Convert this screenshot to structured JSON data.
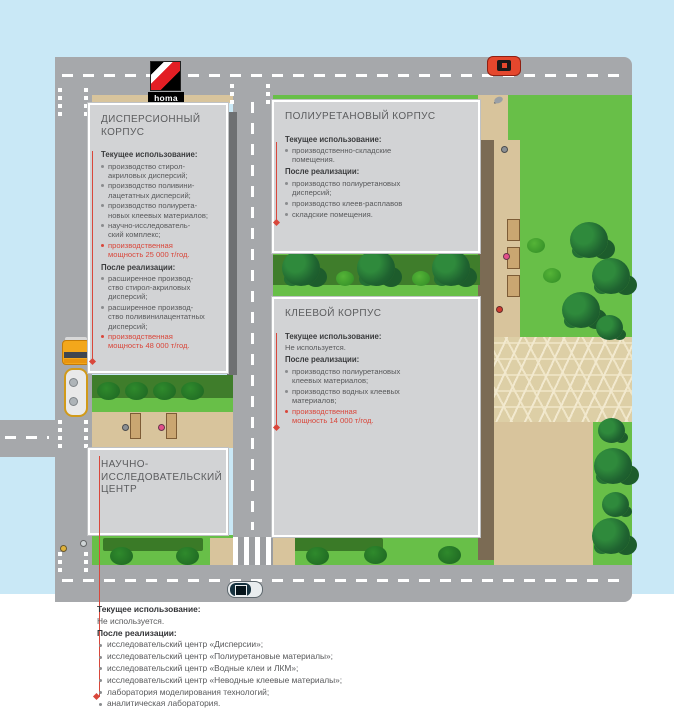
{
  "palette": {
    "accent_red": "#d9473b",
    "grass_green": "#68bf48",
    "road_gray": "#a6a8ab",
    "water_blue": "#c9e8f6",
    "box_gray": "#d2d3d5",
    "path_tan": "#d8c49c",
    "logo_red": "#e31e24"
  },
  "logo": {
    "text": "homa"
  },
  "icons": {
    "red-car": "css-shape",
    "sedan-car": "css-shape",
    "tanker-truck": "css-shape",
    "bench": "css-shape",
    "tree": "css-circle-cluster",
    "bush": "css-circle",
    "pedestrian": "css-dot",
    "bird": "css-oval"
  },
  "b1": {
    "title": "ДИСПЕРСИОННЫЙ\nКОРПУС",
    "sections": [
      {
        "h": "Текущее использование:",
        "items": [
          {
            "t": "производство стирол-\nакриловых дисперсий;"
          },
          {
            "t": "производство поливини-\nлацетатных дисперсий;"
          },
          {
            "t": "производство полиурета-\nновых клеевых материалов;"
          },
          {
            "t": "научно-исследователь-\nский комплекс;"
          },
          {
            "t": "производственная\nмощность 25 000 т/год."
          }
        ]
      },
      {
        "h": "После реализации:",
        "items": [
          {
            "t": "расширенное производ-\nство стирол-акриловых\nдисперсий;"
          },
          {
            "t": "расширенное производ-\nство поливинилацентатных\nдисперсий;"
          },
          {
            "t": "производственная\nмощность 48 000 т/год."
          }
        ]
      }
    ]
  },
  "b2": {
    "title": "ПОЛИУРЕТАНОВЫЙ КОРПУС",
    "sections": [
      {
        "h": "Текущее использование:",
        "items": [
          {
            "t": "производственно-складские\nпомещения."
          }
        ]
      },
      {
        "h": "После реализации:",
        "items": [
          {
            "t": "производство полиуретановых\nдисперсий;"
          },
          {
            "t": "производство клеев-расплавов"
          },
          {
            "t": "складские помещения."
          }
        ]
      }
    ]
  },
  "b3": {
    "title": "КЛЕЕВОЙ КОРПУС",
    "sections": [
      {
        "h": "Текущее использование:",
        "items": [
          {
            "t": "Не используется."
          }
        ]
      },
      {
        "h": "После реализации:",
        "items": [
          {
            "t": "производство полиуретановых\nклеевых материалов;"
          },
          {
            "t": "производство водных клеевых\nматериалов;"
          },
          {
            "t": "производственная\nмощность 14 000 т/год."
          }
        ]
      }
    ]
  },
  "b4": {
    "title": "НАУЧНО-\nИССЛЕДОВАТЕЛЬСКИЙ\nЦЕНТР"
  },
  "footer": {
    "current_label": "Текущее использование:",
    "current_value": "Не используется.",
    "after_label": "После реализации:",
    "items": [
      {
        "t": "исследовательский центр «Дисперсии»;"
      },
      {
        "t": "исследовательский центр «Полиуретановые материалы»;"
      },
      {
        "t": "исследовательский центр «Водные клеи и ЛКМ»;"
      },
      {
        "t": "исследовательский центр «Неводные клеевые материалы»;"
      },
      {
        "t": "лаборатория моделирования технологий;"
      },
      {
        "t": "аналитическая лаборатория."
      }
    ]
  }
}
